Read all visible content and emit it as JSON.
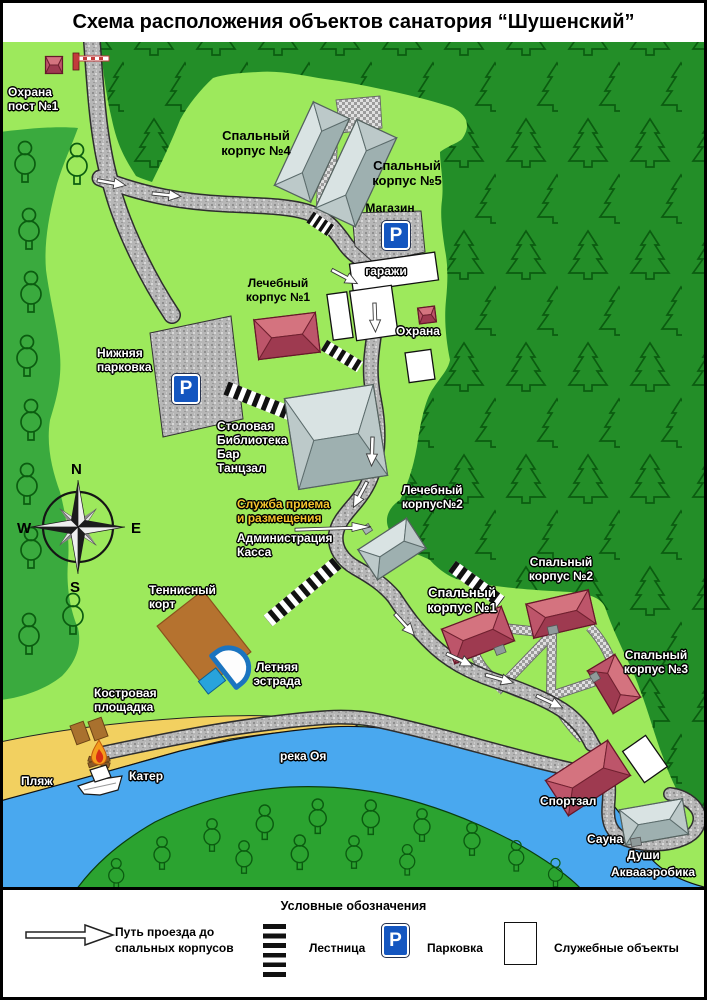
{
  "title": "Схема расположения объектов санатория “Шушенский”",
  "parking_letter": "P",
  "compass": {
    "n": "N",
    "e": "E",
    "s": "S",
    "w": "W"
  },
  "labels": {
    "okhrana_post1": "Охрана\nпост №1",
    "sleeping4": "Спальный\nкорпус №4",
    "sleeping5": "Спальный\nкорпус №5",
    "magazin": "Магазин",
    "garazhi": "гаражи",
    "lechebny1": "Лечебный\nкорпус №1",
    "okhrana": "Охрана",
    "nizhnyaya_parkovka": "Нижняя\nпарковка",
    "stolovaya": "Столовая\nБиблиотека\nБар\nТанцзал",
    "sluzhba": "Служба приема\nи размещения",
    "administratsiya": "Администрация\nКасса",
    "lechebny2": "Лечебный\nкорпус№2",
    "sleeping1": "Спальный\nкорпус №1",
    "sleeping2": "Спальный\nкорпус №2",
    "sleeping3": "Спальный\nкорпус №3",
    "tennis": "Теннисный\nкорт",
    "estrada": "Летняя\nэстрада",
    "kostrovaya": "Костровая\nплощадка",
    "plyazh": "Пляж",
    "kater": "Катер",
    "reka": "река Оя",
    "sportzal": "Спортзал",
    "sauna": "Сауна",
    "dushi": "Души",
    "akvaaerobika": "Аквааэробика"
  },
  "legend": {
    "title": "Условные обозначения",
    "route": "Путь проезда до\nспальных корпусов",
    "stairs": "Лестница",
    "parking": "Парковка",
    "service": "Служебные объекты"
  },
  "colors": {
    "grounds_green": "#9de95c",
    "forest_green": "#238e28",
    "grove_green": "#3aaa3e",
    "far_bank_green": "#2ba330",
    "river_blue": "#49a8ef",
    "beach_sand": "#f2d060",
    "building_red": "#b84e63",
    "building_gray": "#bcc9c9",
    "parking_blue": "#1456c0"
  }
}
